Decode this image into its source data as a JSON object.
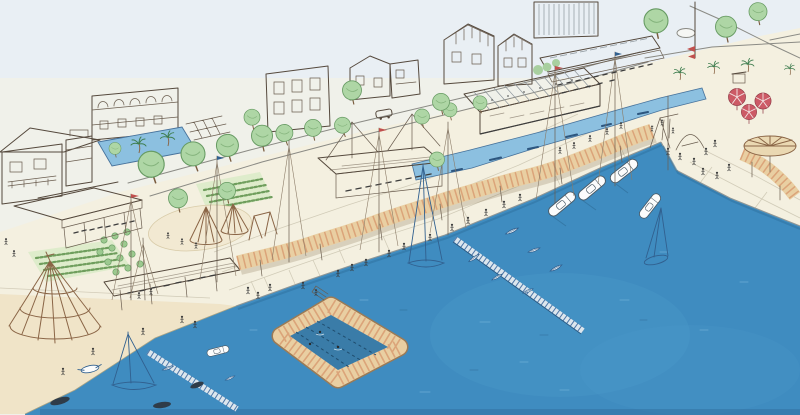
{
  "scene": {
    "type": "hand-drawn architectural concept sketch",
    "subject": "aerial perspective of a waterfront promenade and marina masterplan",
    "medium": "ink line drawing with watercolor washes",
    "text_visible": "none"
  },
  "colors": {
    "paper": "#f0f1ea",
    "sky": "#e9eff4",
    "promenade": "#f4f0e0",
    "sand": "#f0e4c8",
    "harbor_water": "#3f8cc0",
    "canal_water": "#8cc0e0",
    "pool_water": "#3a7ca8",
    "foliage": "#aed6a5",
    "canopy_tan": "#e9cfa2",
    "canopy_stripe": "#d99f74",
    "roof_salmon": "#eab49c",
    "roof_blue": "#74b0d6",
    "umbrella_red": "#cc5a66",
    "glass_roof": "#f2f5f6",
    "ink": "#55493d",
    "boat_ink": "#31608f"
  },
  "features": [
    {
      "id": "town-buildings",
      "label": "line-art town buildings along upper street"
    },
    {
      "id": "coastal-street",
      "label": "street with leaning green trees and a small car"
    },
    {
      "id": "plaza-lap-pool",
      "label": "small blue plaza pool with palm trees (upper left)"
    },
    {
      "id": "blue-roof-pavilion",
      "label": "long open pavilion with blue gabled roof and tables"
    },
    {
      "id": "community-gardens",
      "label": "green planting rows / allotment gardens"
    },
    {
      "id": "orchard",
      "label": "small orchard of round bushes"
    },
    {
      "id": "teepee-playground",
      "label": "sand play area with two teepee frames and swings"
    },
    {
      "id": "climbing-net-cone",
      "label": "large conical rope-climbing structure"
    },
    {
      "id": "beach",
      "label": "sand beach wedge at lower left"
    },
    {
      "id": "beach-pavilion",
      "label": "open pavilion with salmon plank roof"
    },
    {
      "id": "wavy-timber-canopy",
      "label": "undulating tan timber canopy ribbon along promenade"
    },
    {
      "id": "salmon-roof-pavilion",
      "label": "flat salmon-roofed pavilion mid promenade"
    },
    {
      "id": "glass-market-hall",
      "label": "ribbed glass-roofed market hall"
    },
    {
      "id": "water-channel",
      "label": "light blue canal with small boats"
    },
    {
      "id": "promenade",
      "label": "paved quay promenade with joints and strolling figures"
    },
    {
      "id": "marina-basin",
      "label": "deep blue harbor basin"
    },
    {
      "id": "floating-pool",
      "label": "floating swimming pool ring with lane lines"
    },
    {
      "id": "pontoon-docks",
      "label": "ladder-like floating docks with dinghies"
    },
    {
      "id": "moored-motorboats",
      "label": "white motorboats moored at quay corner"
    },
    {
      "id": "sailboats",
      "label": "sailboats with tall masts"
    },
    {
      "id": "red-umbrellas",
      "label": "red striped umbrellas upper right"
    },
    {
      "id": "fan-canopy",
      "label": "round radial fan canopy on right plaza"
    },
    {
      "id": "palm-trees",
      "label": "palm trees"
    },
    {
      "id": "flag-mast",
      "label": "flag mast with red pennants"
    },
    {
      "id": "roads-roundabout",
      "label": "roads and small oval roundabout top right"
    }
  ]
}
